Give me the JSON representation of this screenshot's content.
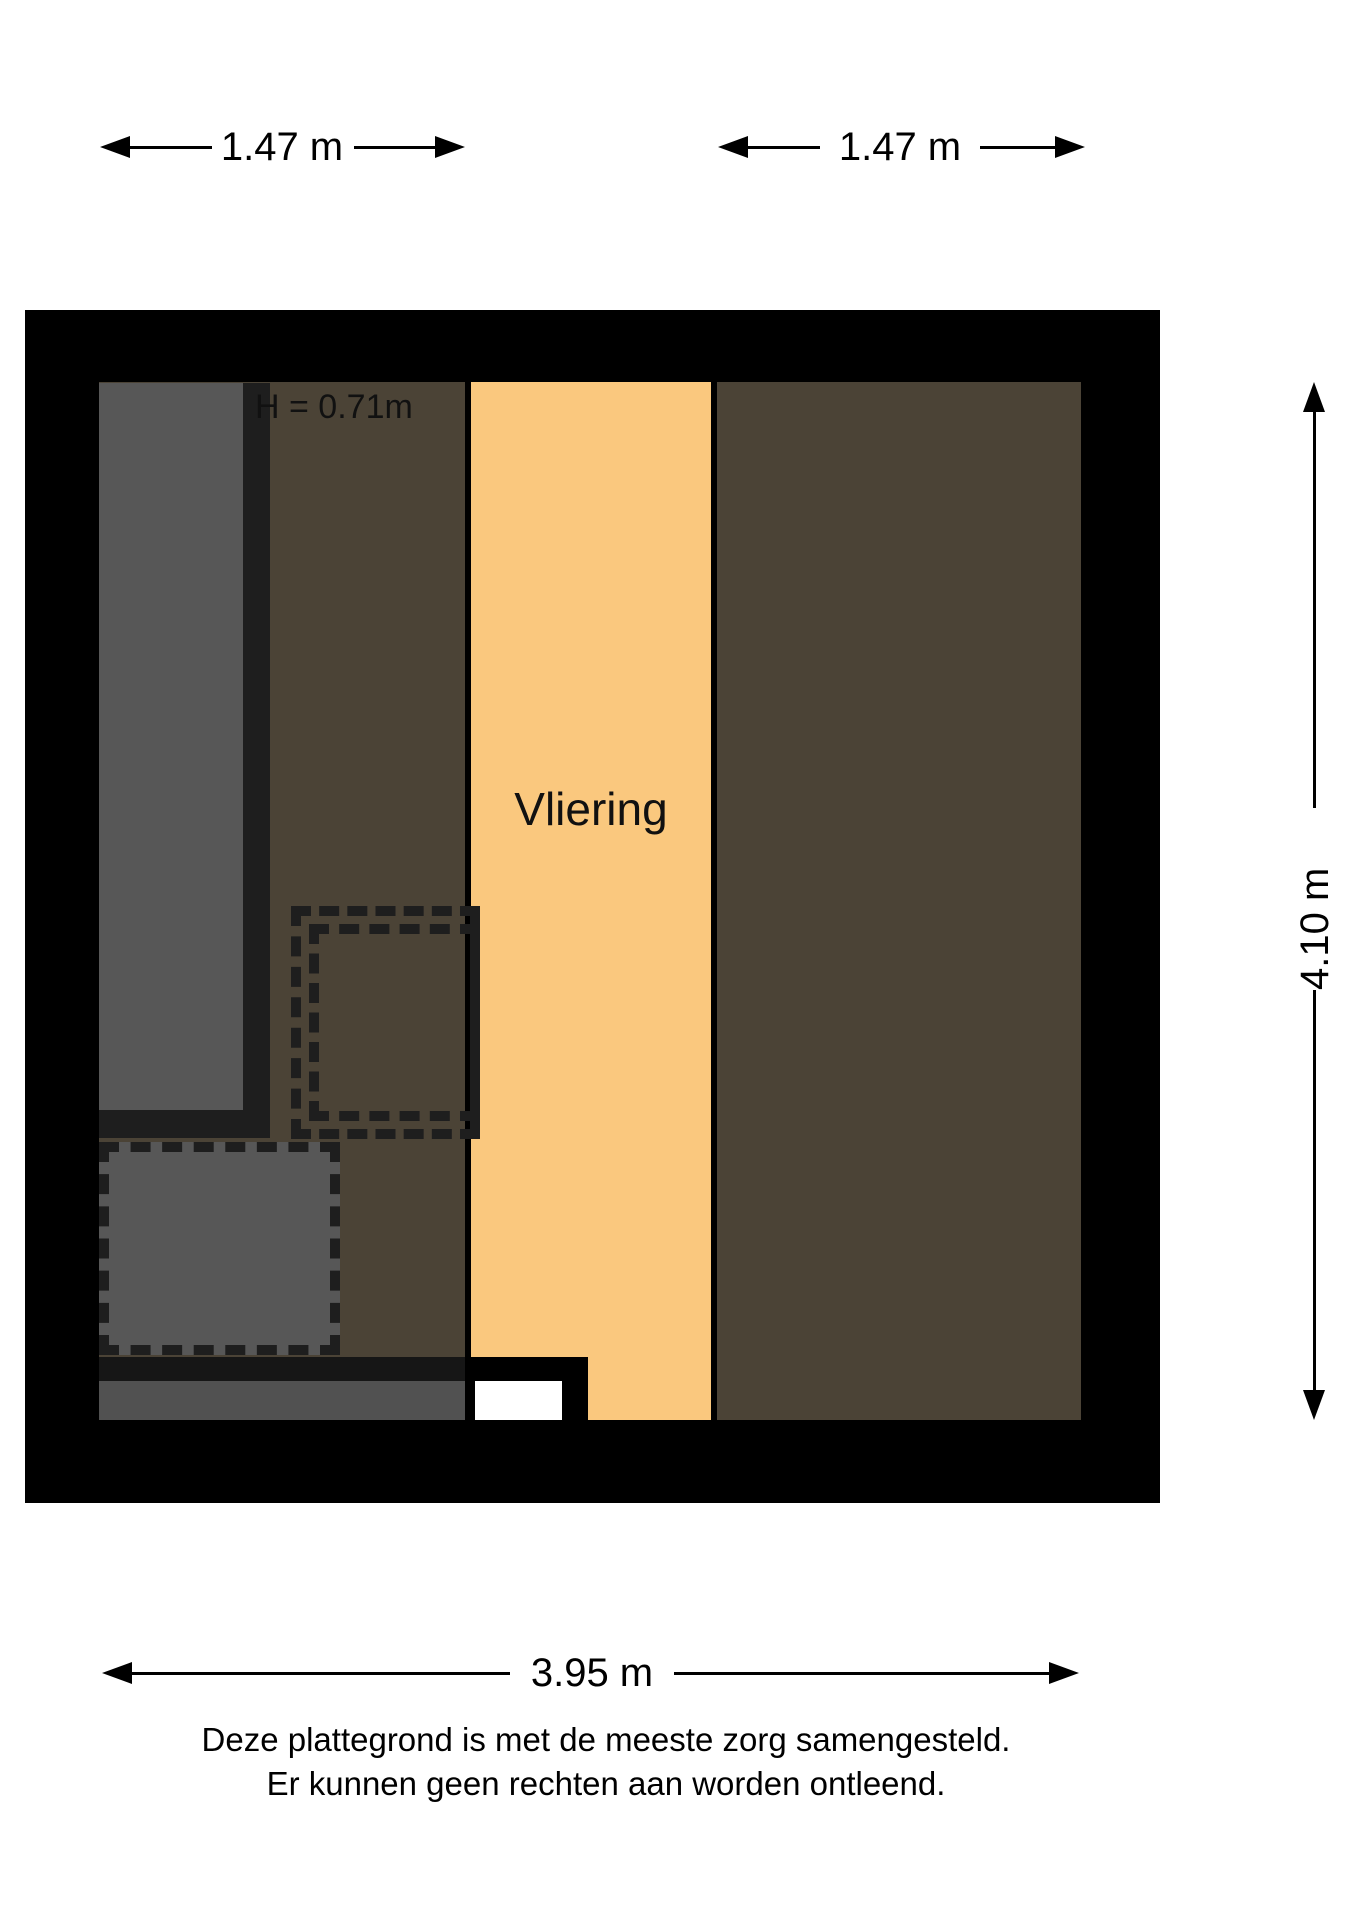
{
  "floorplan": {
    "room_label": "Vliering",
    "height_label": "H = 0.71m",
    "dimensions": {
      "top_left": "1.47 m",
      "top_right": "1.47 m",
      "right": "4.10 m",
      "bottom": "3.95 m"
    },
    "footer": {
      "line1": "Deze plattegrond is met de meeste zorg samengesteld.",
      "line2": "Er kunnen geen rechten aan worden ontleend."
    },
    "colors": {
      "wall": "#000000",
      "loft_floor": "#fac87e",
      "low_headroom_zone": "#4b4336",
      "stairs": "#575757",
      "stair_border": "#1e1e1e",
      "hatch_fill": "#575757",
      "dash": "#1e1e1e"
    }
  }
}
